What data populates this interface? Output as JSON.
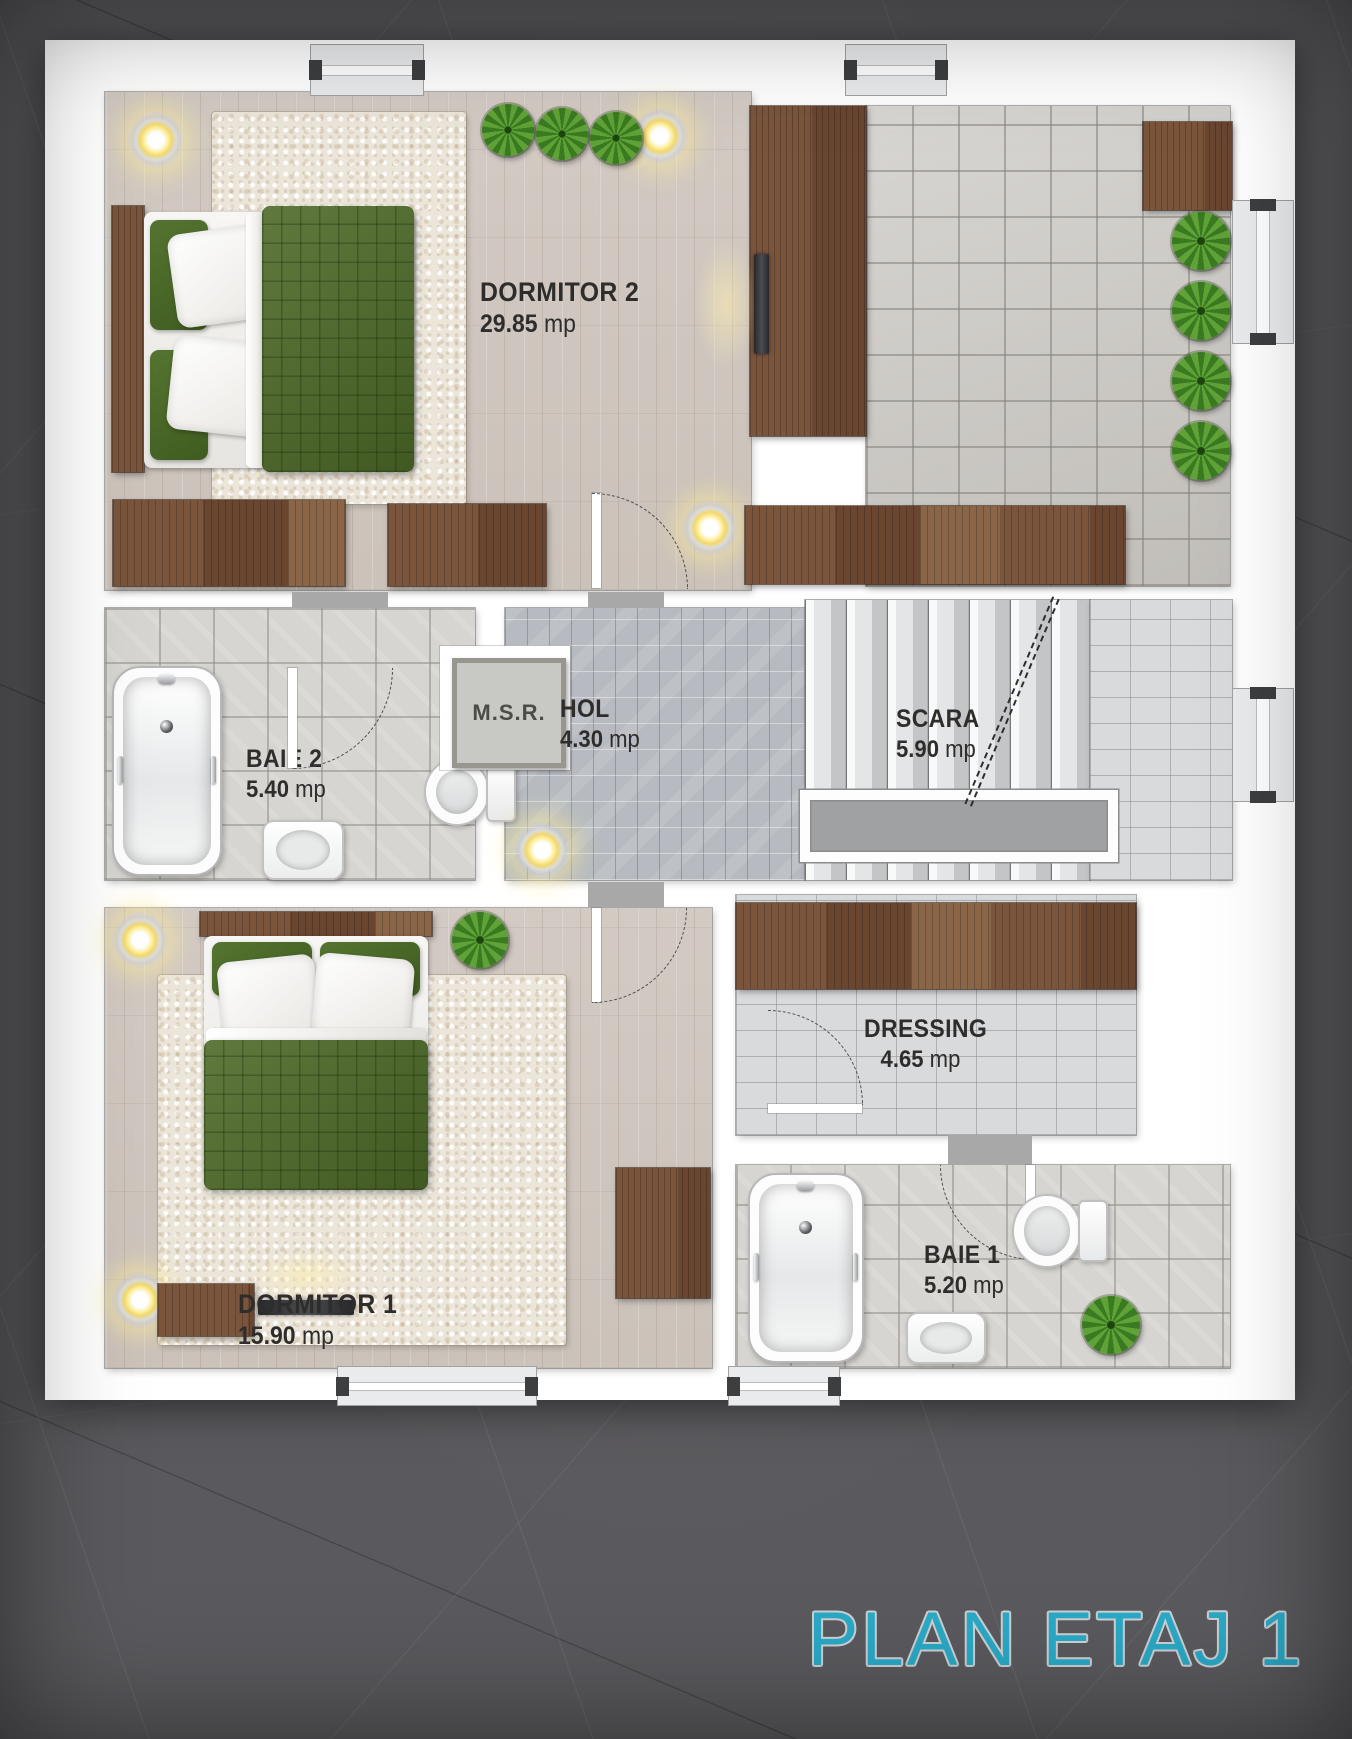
{
  "title": {
    "text": "PLAN ETAJ 1"
  },
  "colors": {
    "title_accent": "#2aa9c6",
    "background": "#5a595d",
    "page": "#ffffff",
    "label_text": "#2e2d2b",
    "quilt_green": "#4d6a28",
    "wood_furniture": "#6f4c36"
  },
  "rooms": {
    "dormitor2": {
      "name": "DORMITOR 2",
      "area_value": "29.85",
      "area_unit": "mp"
    },
    "baie2": {
      "name": "BAIE 2",
      "area_value": "5.40",
      "area_unit": "mp"
    },
    "hol": {
      "name": "HOL",
      "area_value": "4.30",
      "area_unit": "mp"
    },
    "scara": {
      "name": "SCARA",
      "area_value": "5.90",
      "area_unit": "mp"
    },
    "msr": {
      "name": "M.S.R."
    },
    "dormitor1": {
      "name": "DORMITOR 1",
      "area_value": "15.90",
      "area_unit": "mp"
    },
    "dressing": {
      "name": "DRESSING",
      "area_value": "4.65",
      "area_unit": "mp"
    },
    "baie1": {
      "name": "BAIE 1",
      "area_value": "5.20",
      "area_unit": "mp"
    }
  }
}
